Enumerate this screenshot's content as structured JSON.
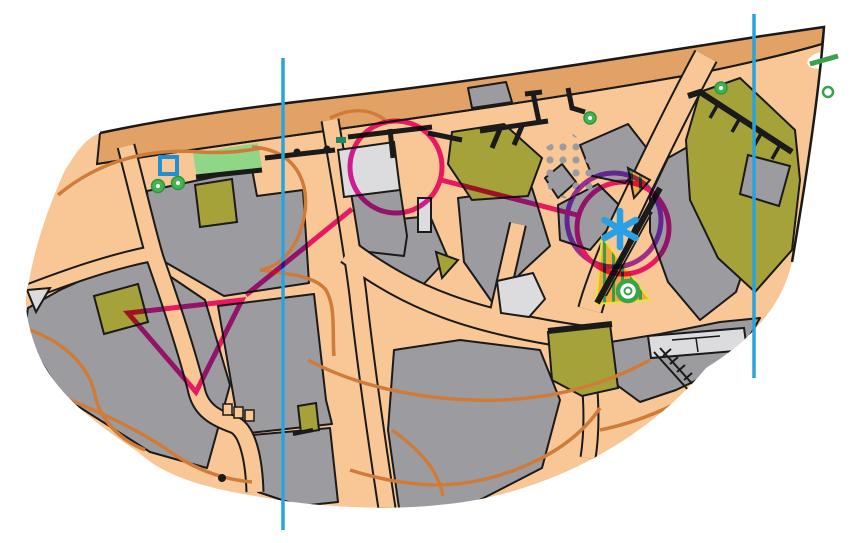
{
  "map": {
    "title": "sprint-orienteering-map",
    "colors": {
      "background": "#ffffff",
      "paved": "#f8c795",
      "road": "#e2a265",
      "building": "#9c9ca0",
      "canopy": "#dcdcde",
      "olive": "#a6a23a",
      "green_area": "#8fd687",
      "tree_green": "#3aa24b",
      "contour_orange": "#cf7c3a",
      "north_line_blue": "#2aa3dd",
      "course_magenta": "#ee1fa6",
      "course_violet": "#a23ce8",
      "marker_blue": "#2aa0e6",
      "wall_black": "#1a1a1a",
      "undergrowth_fill": "#f2a93d",
      "undergrowth_stripe": "#3f9b41",
      "teal_mark": "#1c8a66",
      "well_blue": "#1f8fd6"
    },
    "north_lines": [
      {
        "x": 283,
        "y1": 58,
        "y2": 530
      },
      {
        "x": 754,
        "y1": 14,
        "y2": 378
      }
    ],
    "course": {
      "start_triangle": [
        [
          128,
          313
        ],
        [
          242,
          300
        ],
        [
          196,
          392
        ]
      ],
      "legs": [
        [
          [
            246,
            295
          ],
          [
            352,
            209
          ]
        ],
        [
          [
            441,
            180
          ],
          [
            577,
            215
          ]
        ]
      ],
      "controls": [
        {
          "id": "control-1",
          "cx": 396,
          "cy": 167,
          "r": 46
        },
        {
          "id": "control-2",
          "cx": 623,
          "cy": 228,
          "r": 46
        }
      ],
      "extra_circle": {
        "id": "control-2-alt",
        "cx": 614,
        "cy": 220,
        "r": 47
      },
      "stroke_width": 5
    },
    "marker": {
      "type": "asterisk",
      "x": 620,
      "y": 229,
      "arm": 18,
      "width": 6.5
    },
    "point_symbols": {
      "trees": [
        {
          "cx": 158,
          "cy": 186,
          "r": 6.5
        },
        {
          "cx": 178,
          "cy": 183,
          "r": 6.5
        },
        {
          "cx": 590,
          "cy": 118,
          "r": 6
        },
        {
          "cx": 721,
          "cy": 88,
          "r": 6
        }
      ],
      "prominent_tree": {
        "cx": 628,
        "cy": 291,
        "r": 10
      },
      "tree_ring": {
        "cx": 828,
        "cy": 92,
        "r": 5
      },
      "well_square": {
        "x": 160,
        "y": 157,
        "size": 17
      },
      "green_dash": {
        "x1": 810,
        "y1": 64,
        "x2": 838,
        "y2": 56
      }
    }
  }
}
